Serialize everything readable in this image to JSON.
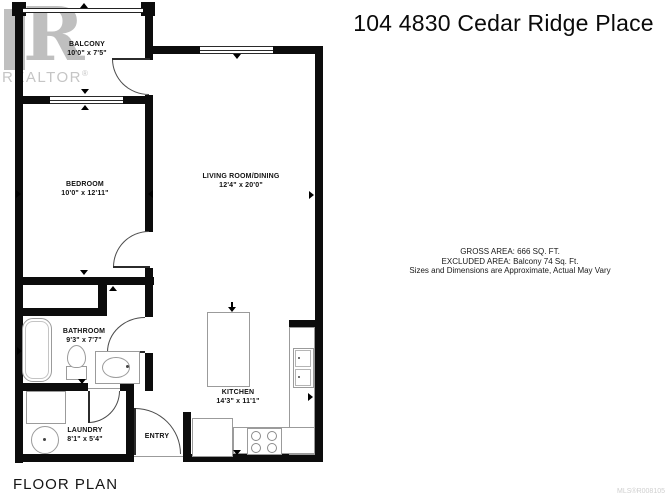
{
  "title": "104 4830 Cedar Ridge Place",
  "floor_plan_label": "FLOOR PLAN",
  "watermark": {
    "logo_letter": "R",
    "brand": "REALTOR",
    "registered": "®",
    "mls_code": "MLS®R008105"
  },
  "area_info": {
    "gross": "GROSS AREA: 666 SQ. FT.",
    "excluded": "EXCLUDED AREA: Balcony 74 Sq. Ft.",
    "disclaimer": "Sizes and Dimensions are Approximate, Actual May Vary"
  },
  "rooms": {
    "balcony": {
      "name": "BALCONY",
      "dims": "10'0\" x 7'5\""
    },
    "bedroom": {
      "name": "BEDROOM",
      "dims": "10'0\" x 12'11\""
    },
    "living": {
      "name": "LIVING ROOM/DINING",
      "dims": "12'4\" x 20'0\""
    },
    "bathroom": {
      "name": "BATHROOM",
      "dims": "9'3\" x 7'7\""
    },
    "kitchen": {
      "name": "KITCHEN",
      "dims": "14'3\" x 11'1\""
    },
    "laundry": {
      "name": "LAUNDRY",
      "dims": "8'1\" x 5'4\""
    },
    "entry": {
      "name": "ENTRY"
    }
  },
  "colors": {
    "wall": "#0c0c0c",
    "fixture_outline": "#9b9b9b",
    "watermark_gray": "#c2c2c2"
  }
}
